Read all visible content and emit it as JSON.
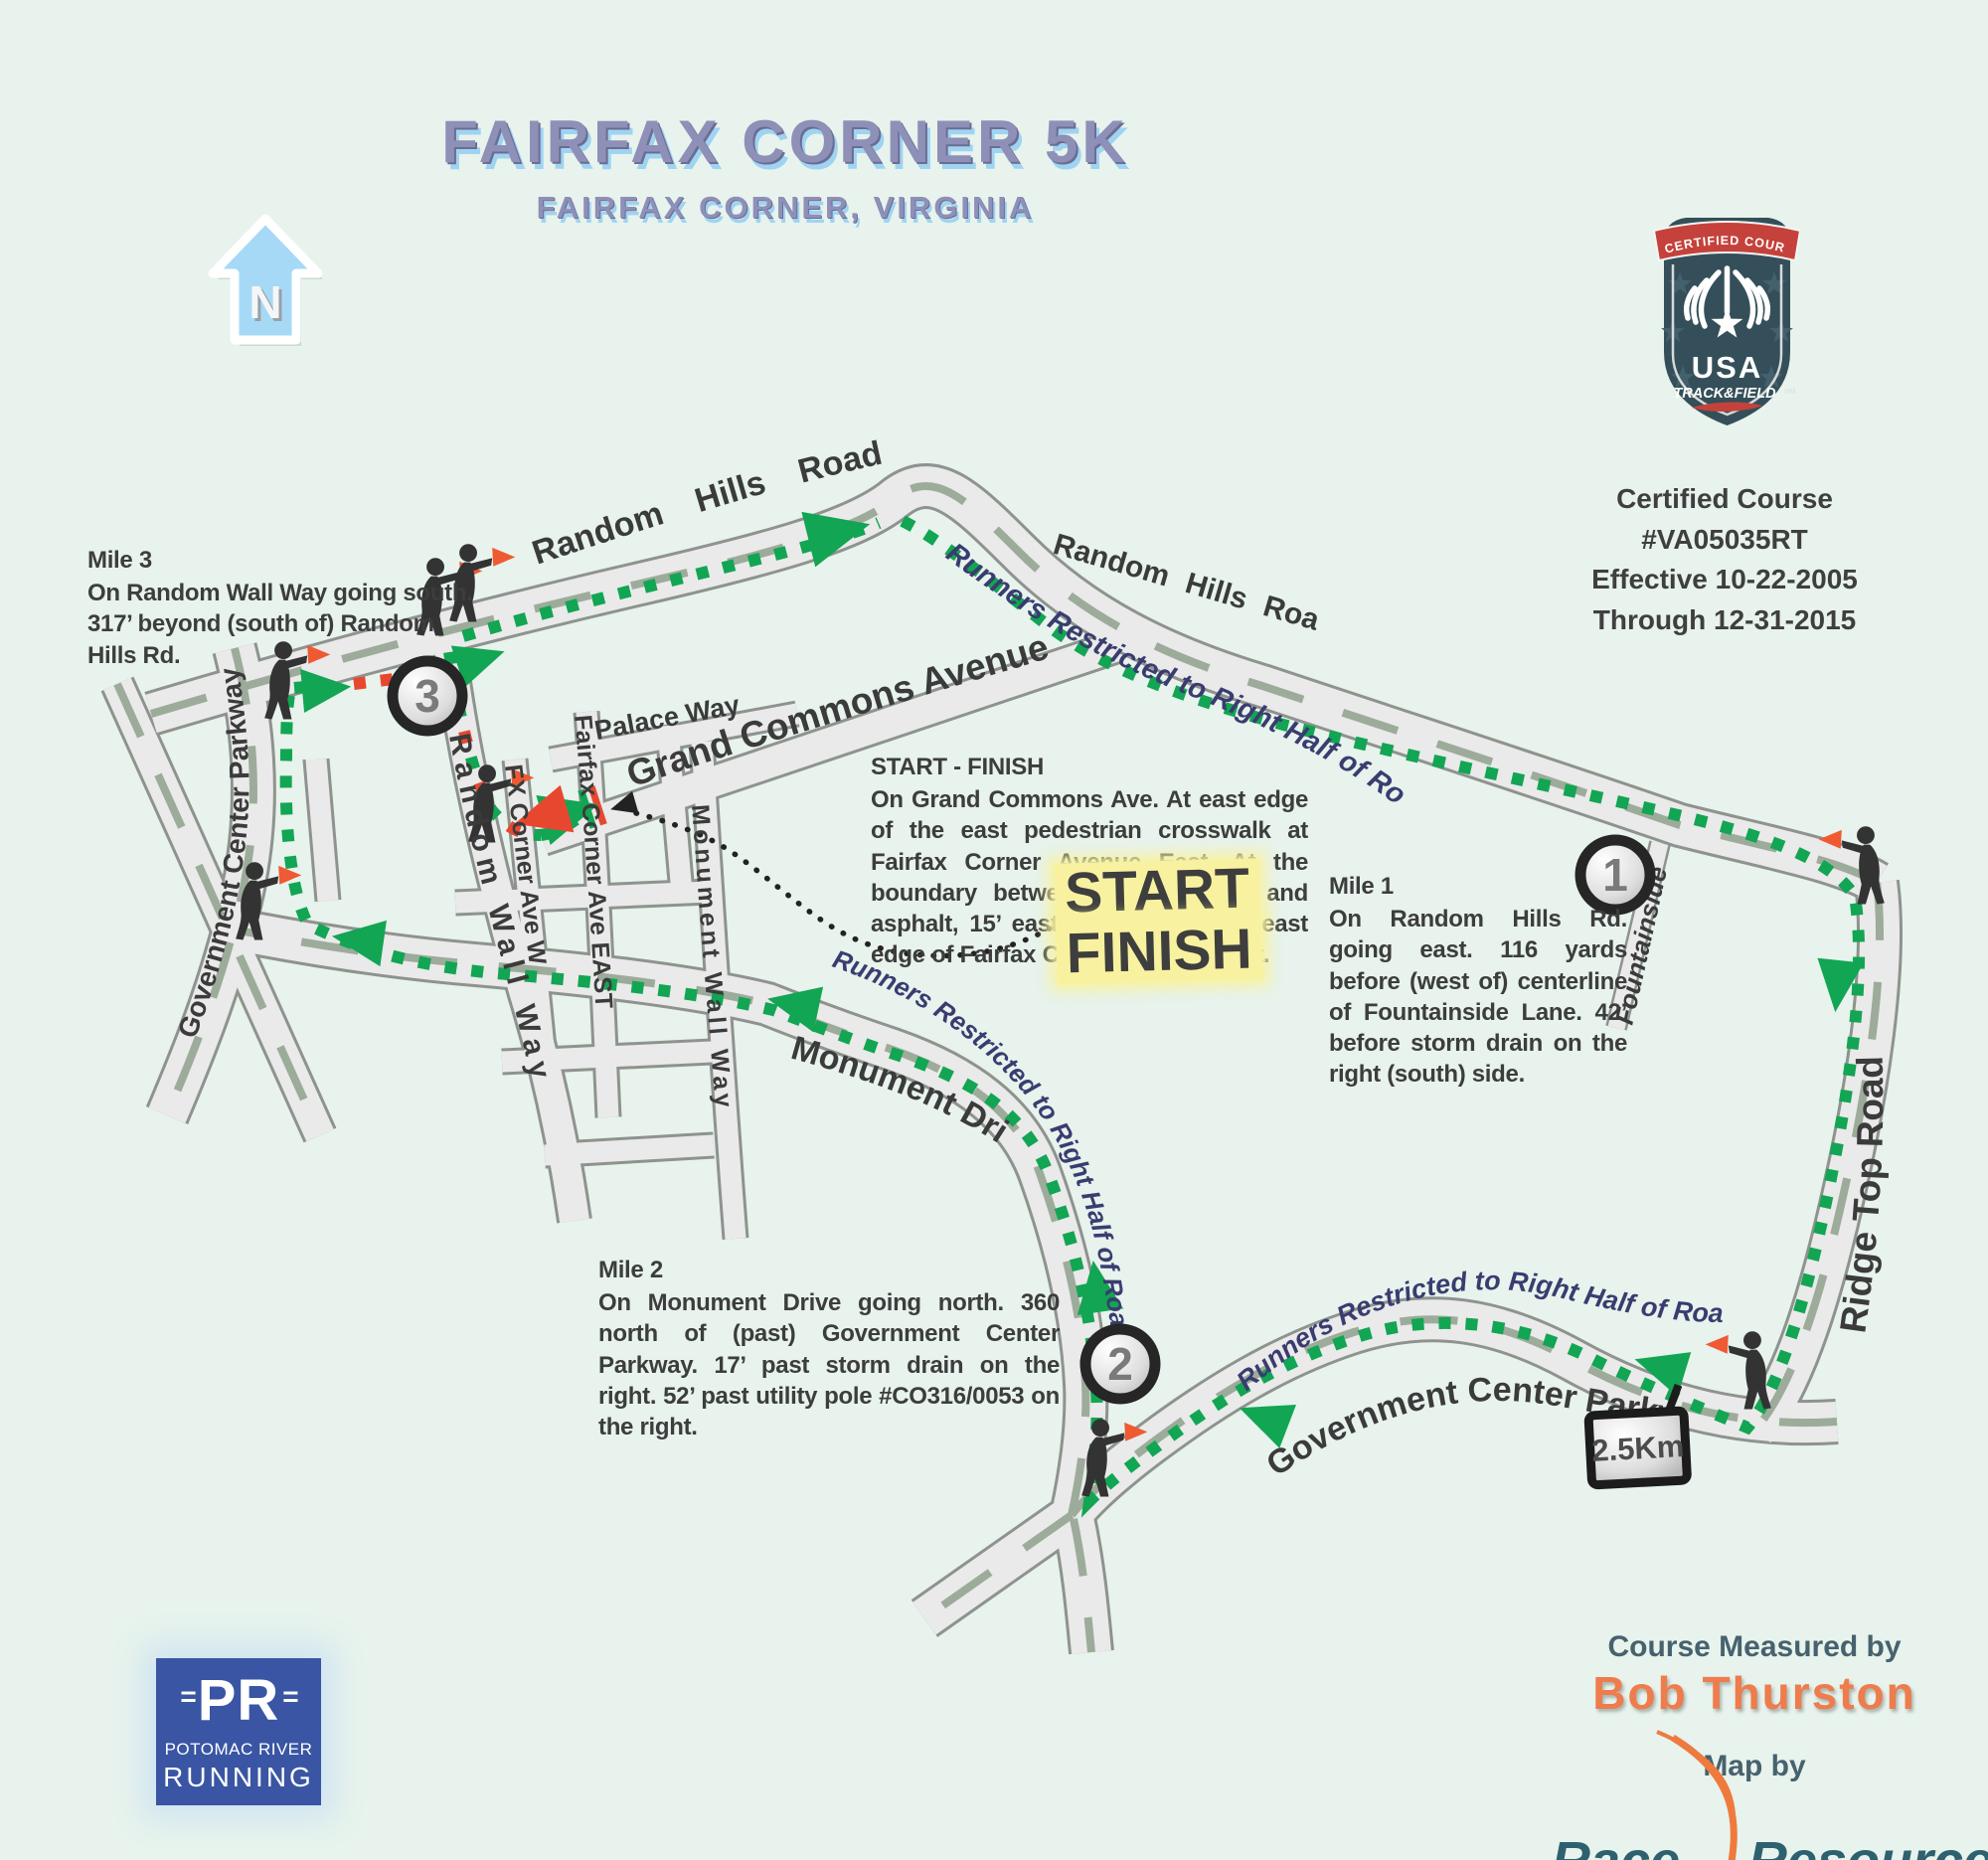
{
  "title": "FAIRFAX CORNER 5K",
  "subtitle": "FAIRFAX CORNER, VIRGINIA",
  "north": {
    "label": "N"
  },
  "badge": {
    "banner": "CERTIFIED COURSE",
    "org": "USA",
    "org2": "TRACK&FIELD",
    "trademark": "SM"
  },
  "certification": {
    "line1": "Certified Course #VA05035RT",
    "line2": "Effective 10-22-2005",
    "line3": "Through 12-31-2015"
  },
  "notes": {
    "mile3": {
      "title": "Mile 3",
      "body": "On Random Wall Way going south. 317’ beyond (south of) Random Hills Rd."
    },
    "start_finish": {
      "title": "START - FINISH",
      "body": "On Grand Commons Ave. At east edge of the east pedestrian crosswalk at Fairfax Corner Avenue East. At the boundary between the concrete and asphalt, 15’ east of the extended east edge of Fairfax Corner Avenue East."
    },
    "mile1": {
      "title": "Mile 1",
      "body": "On Random Hills Rd. going east. 116 yards before (west of) centerline of Fountainside Lane. 42’ before storm drain on the right (south) side."
    },
    "mile2": {
      "title": "Mile 2",
      "body": "On Monument Drive going north. 360 north of (past) Government Center Parkway. 17’ past storm drain on the right. 52’ past utility pole #CO316/0053 on the right."
    }
  },
  "map": {
    "start_marker": {
      "line1": "START",
      "line2": "FINISH"
    },
    "mile_markers": {
      "m1": "1",
      "m2": "2",
      "m3": "3"
    },
    "distance_sign": "2.5Km",
    "restriction": "Runners Restricted to Right Half of Road",
    "roads": {
      "random_hills": "Random Hills Road",
      "government_center": "Government Center Parkway",
      "monument_drive": "Monument Drive",
      "random_wall": "Random Wall Way",
      "grand_commons": "Grand Commons Avenue",
      "palace": "Palace Way",
      "fairfax_corner_east": "Fairfax Corner Ave EAST",
      "fx_corner_west": "FX Corner Ave W",
      "monument_wall": "Monument Wall Way",
      "fountainside": "Fountainside",
      "ridge_top": "Ridge Top Road"
    }
  },
  "footer": {
    "pr": {
      "eq_left": "=",
      "initials": "PR",
      "eq_right": "=",
      "line2": "POTOMAC RIVER",
      "line3": "RUNNING"
    },
    "measured_label": "Course Measured by",
    "measured_name": "Bob Thurston",
    "map_by_label": "Map by",
    "brand_word1": "Race",
    "brand_word2": "Resources"
  },
  "colors": {
    "background": "#e7f3ec",
    "route_green": "#12a553",
    "route_red": "#e8472f",
    "restriction_navy": "#3a3c70",
    "highlight_yellow": "#f8f2a0",
    "badge_red": "#c4423b",
    "badge_slate": "#344f59",
    "pr_blue": "#3a55a3",
    "brand_orange": "#ee7a3e",
    "brand_teal": "#2e6170"
  }
}
